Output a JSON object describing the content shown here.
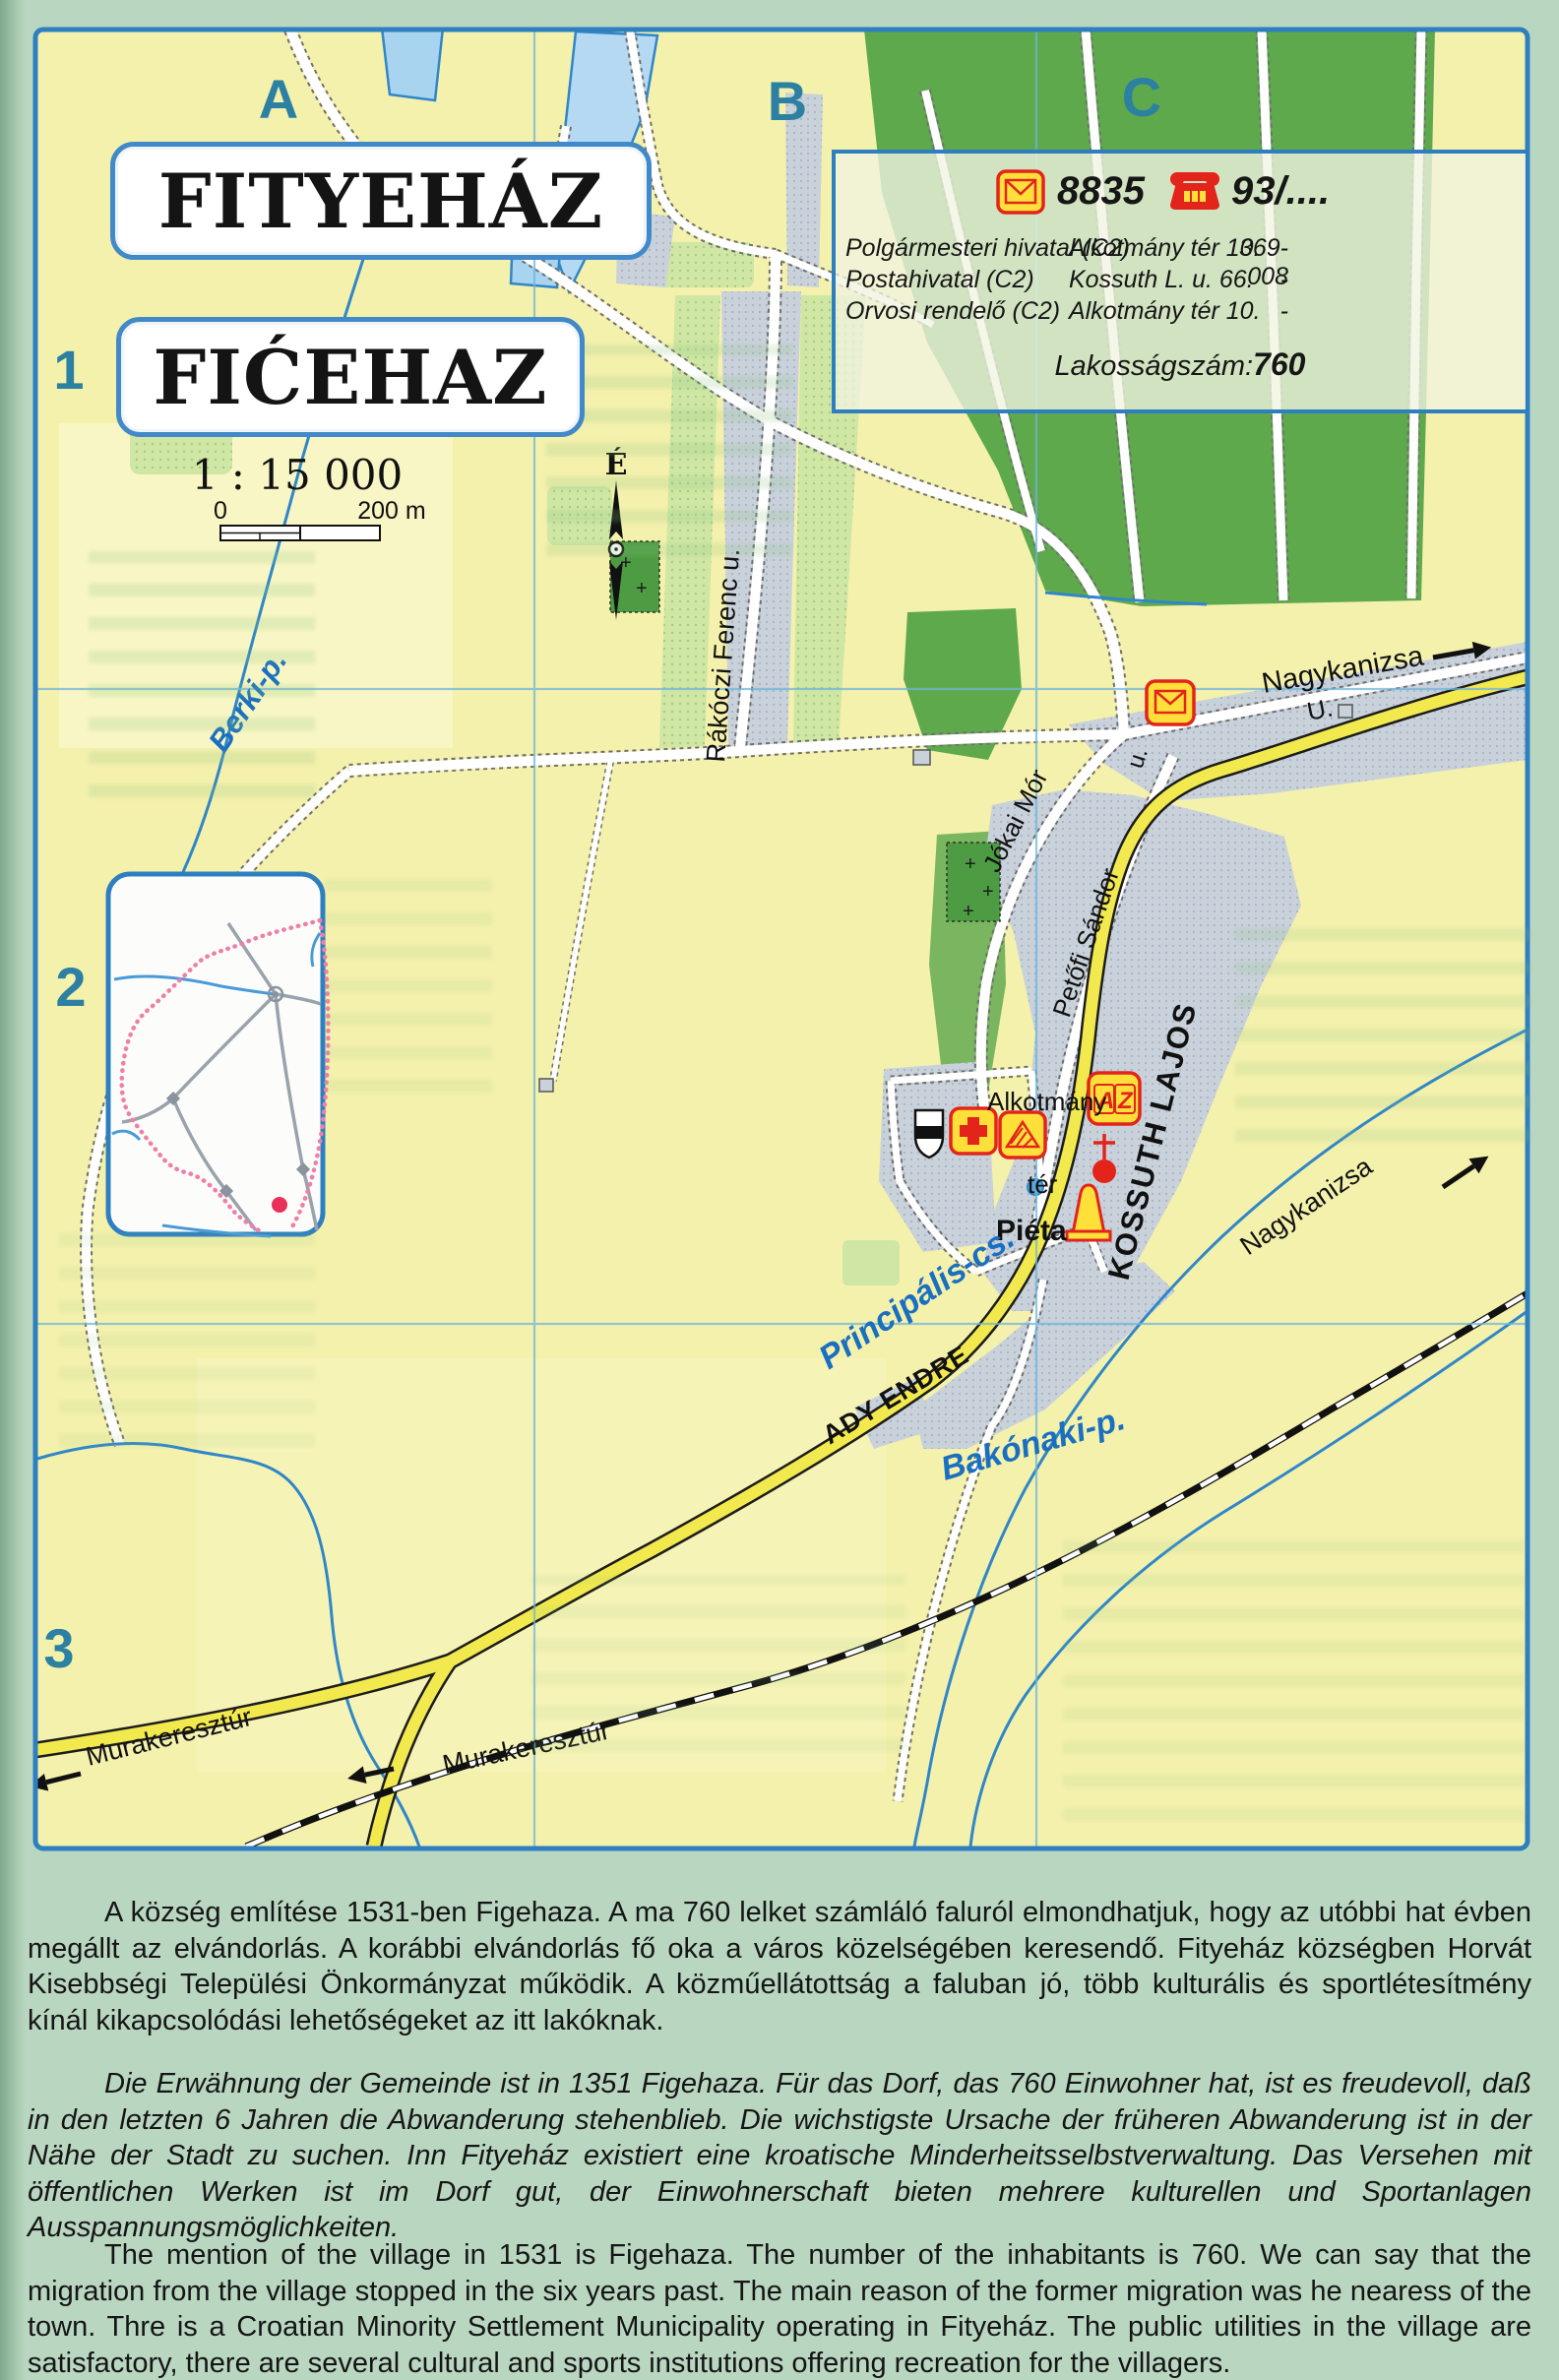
{
  "header": {
    "title_hu": "FITYEHÁZ",
    "title_hr": "FIĆEHAZ",
    "scale_ratio": "1 : 15 000",
    "scale_zero": "0",
    "scale_end": "200 m",
    "north_letter": "É"
  },
  "grid": {
    "columns": [
      "A",
      "B",
      "C"
    ],
    "rows": [
      "1",
      "2",
      "3"
    ]
  },
  "info_box": {
    "postal_code": "8835",
    "phone_code": "93/....",
    "entries": [
      {
        "name": "Polgármesteri hivatal (C2)",
        "address": "Alkotmány tér 10.",
        "phone": "369-008"
      },
      {
        "name": "Postahivatal (C2)",
        "address": "Kossuth L. u. 66.",
        "phone": "-"
      },
      {
        "name": "Orvosi rendelő (C2)",
        "address": "Alkotmány tér 10.",
        "phone": "-"
      }
    ],
    "population_label": "Lakosságszám:",
    "population_value": "760"
  },
  "map_labels": {
    "streets": {
      "rakoczi": "Rákóczi Ferenc u.",
      "jokai": "Jókai Mór",
      "petofi": "Petőfi Sándor",
      "kossuth": "KOSSUTH LAJOS",
      "ady": "ADY ENDRE",
      "u_short": "u.",
      "u_cap": "U.",
      "alkotmany": "Alkotmány",
      "ter": "tér",
      "pieta": "Piéta"
    },
    "destinations": {
      "nagykanizsa_road": "Nagykanizsa",
      "nagykanizsa_rail": "Nagykanizsa",
      "murakeresztur_road": "Murakeresztúr",
      "murakeresztur_rail": "Murakeresztúr"
    },
    "waters": {
      "berki": "Berki-p.",
      "principalis": "Principális-cs.",
      "bakonaki": "Bakónaki-p."
    },
    "icons": {
      "az_a": "A",
      "az_z": "Z"
    }
  },
  "paragraphs": {
    "hu": "A község említése 1531-ben Figehaza. A ma 760 lelket számláló faluról elmondhatjuk, hogy az utóbbi hat évben megállt az elvándorlás. A korábbi elvándorlás fő oka a város közelségében keresendő. Fityeház községben Horvát Kisebbségi Települési Önkormányzat működik. A közműellátottság a faluban jó, több kulturális és sportlétesítmény kínál kikapcsolódási lehetőségeket az itt lakóknak.",
    "de": "Die Erwähnung der Gemeinde ist in 1351 Figehaza. Für das Dorf, das 760 Einwohner hat, ist es freudevoll, daß in den letzten 6 Jahren die Abwanderung stehenblieb. Die wichstigste Ursache der früheren Abwanderung ist in der Nähe der Stadt zu suchen. Inn Fityeház existiert eine kroatische Minderheitsselbstverwaltung. Das Versehen mit öffentlichen Werken ist im Dorf gut, der Einwohnerschaft bieten mehrere kulturellen und Sportanlagen Ausspannungsmöglichkeiten.",
    "en": "The mention of the village in 1531 is Figehaza. The number of the inhabitants is 760. We can say that the migration from the village stopped in the six years past. The main reason of the former migration was he nearess of the town. Thre is a Croatian Minority Settlement Municipality operating in Fityeház. The public utilities in the village are satisfactory, there are several cultural and sports institutions offering recreation for the villagers."
  },
  "colors": {
    "frame_blue": "#2e7fc0",
    "map_yellow": "#f4f1ac",
    "forest_green": "#5fa94d",
    "builtup_gray": "#c9d1da",
    "road_yellow": "#f2e94e",
    "water_blue": "#2f86c8",
    "accent_red": "#e3241b",
    "icon_yellow": "#ffe03a",
    "label_teal": "#2c80a2",
    "boundary_pink": "#f07fa8"
  }
}
